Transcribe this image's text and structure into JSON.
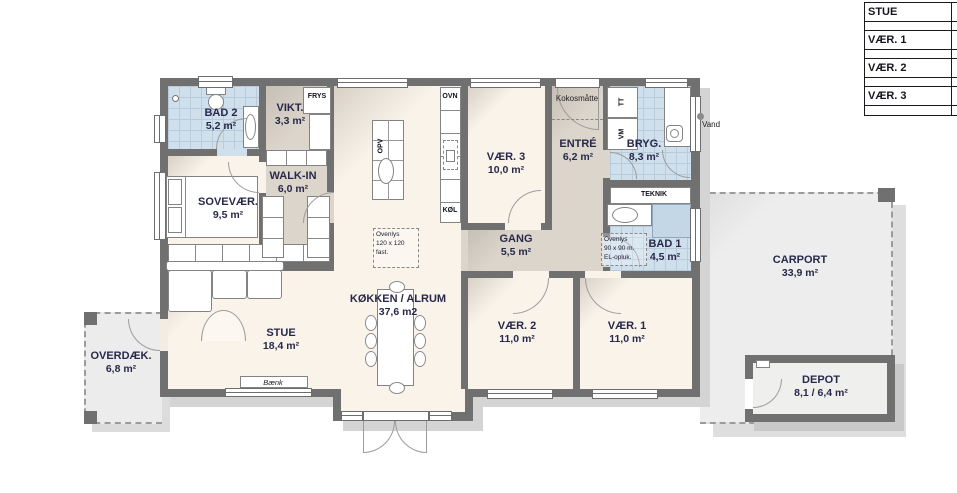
{
  "legend": {
    "rows": [
      "STUE",
      "",
      "VÆR. 1",
      "",
      "VÆR. 2",
      "",
      "VÆR. 3",
      ""
    ]
  },
  "rooms": {
    "bad2": {
      "name": "BAD 2",
      "area": "5,2 m²"
    },
    "vikt": {
      "name": "VIKT.",
      "area": "3,3 m²"
    },
    "sovevaer": {
      "name": "SOVEVÆR.",
      "area": "9,5 m²"
    },
    "walkin": {
      "name": "WALK-IN",
      "area": "6,0 m²"
    },
    "kokken": {
      "name": "KØKKEN / ALRUM",
      "area": "37,6 m2"
    },
    "vaer3": {
      "name": "VÆR. 3",
      "area": "10,0 m²"
    },
    "entre": {
      "name": "ENTRÉ",
      "area": "6,2 m²"
    },
    "bryg": {
      "name": "BRYG.",
      "area": "8,3 m²"
    },
    "gang": {
      "name": "GANG",
      "area": "5,5 m²"
    },
    "bad1": {
      "name": "BAD 1",
      "area": "4,5 m²"
    },
    "vaer2": {
      "name": "VÆR. 2",
      "area": "11,0 m²"
    },
    "vaer1": {
      "name": "VÆR. 1",
      "area": "11,0 m²"
    },
    "stue": {
      "name": "STUE",
      "area": "18,4 m²"
    },
    "overdaek": {
      "name": "OVERDÆK.",
      "area": "6,8 m²"
    },
    "carport": {
      "name": "CARPORT",
      "area": "33,9 m²"
    },
    "depot": {
      "name": "DEPOT",
      "area": "8,1 / 6,4 m²"
    }
  },
  "fixtures": {
    "frys": "FRYS",
    "ovn": "OVN",
    "koel": "KØL",
    "opv": "OPV",
    "vm": "VM",
    "tt": "TT",
    "teknik": "TEKNIK",
    "kokosmatte": "Kokosmåtte",
    "vand": "Vand",
    "baenk": "Bænk"
  },
  "notes": {
    "kitchen_skylight": {
      "l1": "Ovenlys",
      "l2": "120 x 120",
      "l3": "fast."
    },
    "bad1_skylight": {
      "l1": "Ovenlys",
      "l2": "90 x 90 m.",
      "l3": "EL-opluk."
    }
  },
  "colors": {
    "wall": "#707070",
    "tile": "#cfdfec",
    "floor": "#f9f2e9",
    "circulation": "#dcd5cc",
    "shadow": "#d4d4d4"
  }
}
